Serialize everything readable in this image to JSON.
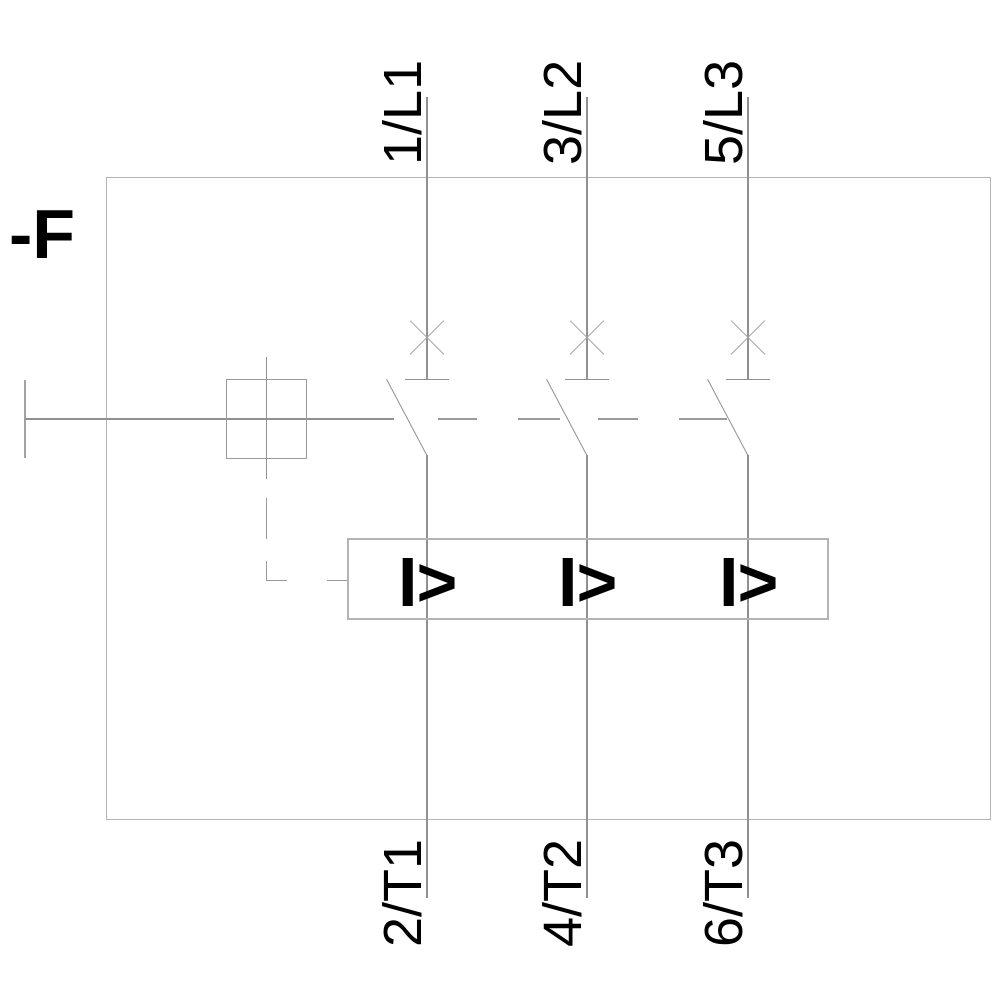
{
  "diagram": {
    "device_label": "-F",
    "overload_release_symbol": "I>",
    "poles": [
      {
        "top_terminal": "1/L1",
        "bottom_terminal": "2/T1"
      },
      {
        "top_terminal": "3/L2",
        "bottom_terminal": "4/T2"
      },
      {
        "top_terminal": "5/L3",
        "bottom_terminal": "6/T3"
      }
    ],
    "colors": {
      "line_gray": "#919191",
      "frame_gray": "#b4b4b4",
      "dash_gray": "#9a9a9a",
      "xmark_gray": "#a3a3a3",
      "text_black": "#000000",
      "background": "#ffffff"
    }
  }
}
